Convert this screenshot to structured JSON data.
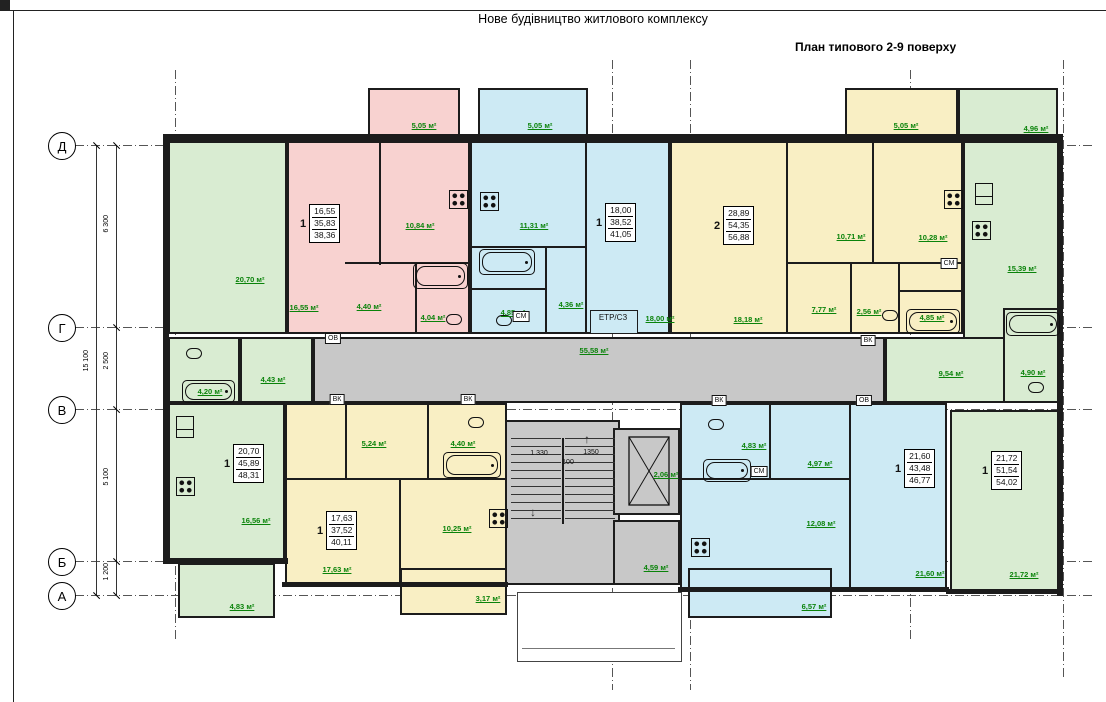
{
  "title": "Нове будівництво житлового комплексу",
  "subtitle": "План типового 2-9 поверху",
  "axes": {
    "rows": [
      {
        "label": "Д"
      },
      {
        "label": "Г"
      },
      {
        "label": "В"
      },
      {
        "label": "Б"
      },
      {
        "label": "А"
      }
    ],
    "dims": {
      "total": "15 100",
      "d_g": "6 300",
      "g_v": "2 500",
      "v_b": "5 100",
      "b_a": "1 200"
    }
  },
  "stairs": {
    "dim1": "1 330",
    "dim2": "1350",
    "dim3": "100"
  },
  "shafts": {
    "ov": "ОВ",
    "vk": "ВК",
    "sm": "СМ",
    "etr": "ЕТР/СЗ"
  },
  "areas": {
    "top_left_room": "20,70 м²",
    "pink_room": "16,55 м²",
    "pink_kitchen": "10,84 м²",
    "pink_hall": "4,40 м²",
    "pink_bath": "4,04 м²",
    "pink_balcony": "5,05 м²",
    "cyan_kitchen": "11,31 м²",
    "cyan_hall": "4,36 м²",
    "cyan_bath": "4,85 м²",
    "cyan_room": "18,00 м²",
    "cyan_balcony": "5,05 м²",
    "yt_room1": "18,18 м²",
    "yt_room2": "10,71 м²",
    "yt_kitchen": "10,28 м²",
    "yt_hall": "7,77 м²",
    "yt_wc": "2,56 м²",
    "yt_bath": "4,85 м²",
    "yt_balcony": "5,05 м²",
    "gtr_kitchen": "15,39 м²",
    "gtr_balcony": "4,96 м²",
    "gtr_hall": "9,54 м²",
    "gtr_bath": "4,90 м²",
    "corridor": "55,58 м²",
    "lobby": "4,59 м²",
    "elevator": "2,06 м²",
    "gl_bath": "4,20 м²",
    "gl_hall": "4,43 м²",
    "gbl_room": "16,56 м²",
    "gbl_balcony": "4,83 м²",
    "yb_hall": "5,24 м²",
    "yb_bath": "4,40 м²",
    "yb_kitchen": "10,25 м²",
    "yb_room": "17,63 м²",
    "yb_balcony": "3,17 м²",
    "blue_bath": "4,83 м²",
    "blue_hall": "4,97 м²",
    "blue_kitchen": "12,08 м²",
    "blue_room": "21,60 м²",
    "blue_balcony": "6,57 м²",
    "gbr_room": "21,72 м²"
  },
  "apartments": {
    "pink": {
      "count": "1",
      "living": "16,55",
      "area": "35,83",
      "total": "38,36"
    },
    "cyan": {
      "count": "1",
      "living": "18,00",
      "area": "38,52",
      "total": "41,05"
    },
    "yellow_top": {
      "count": "2",
      "living": "28,89",
      "area": "54,35",
      "total": "56,88"
    },
    "green_bottom_left": {
      "count": "1",
      "living": "20,70",
      "area": "45,89",
      "total": "48,31"
    },
    "yellow_bottom": {
      "count": "1",
      "living": "17,63",
      "area": "37,52",
      "total": "40,11"
    },
    "blue": {
      "count": "1",
      "living": "21,60",
      "area": "43,48",
      "total": "46,77"
    },
    "green_bottom_right": {
      "count": "1",
      "living": "21,72",
      "area": "51,54",
      "total": "54,02"
    }
  },
  "colors": {
    "green": "#d9ecd2",
    "pink": "#f8d2d0",
    "cyan": "#cdeaf4",
    "yellow": "#f9efc4",
    "gray": "#c8c8c8",
    "wall": "#1c1c1c",
    "area_label": "#0a830a"
  }
}
